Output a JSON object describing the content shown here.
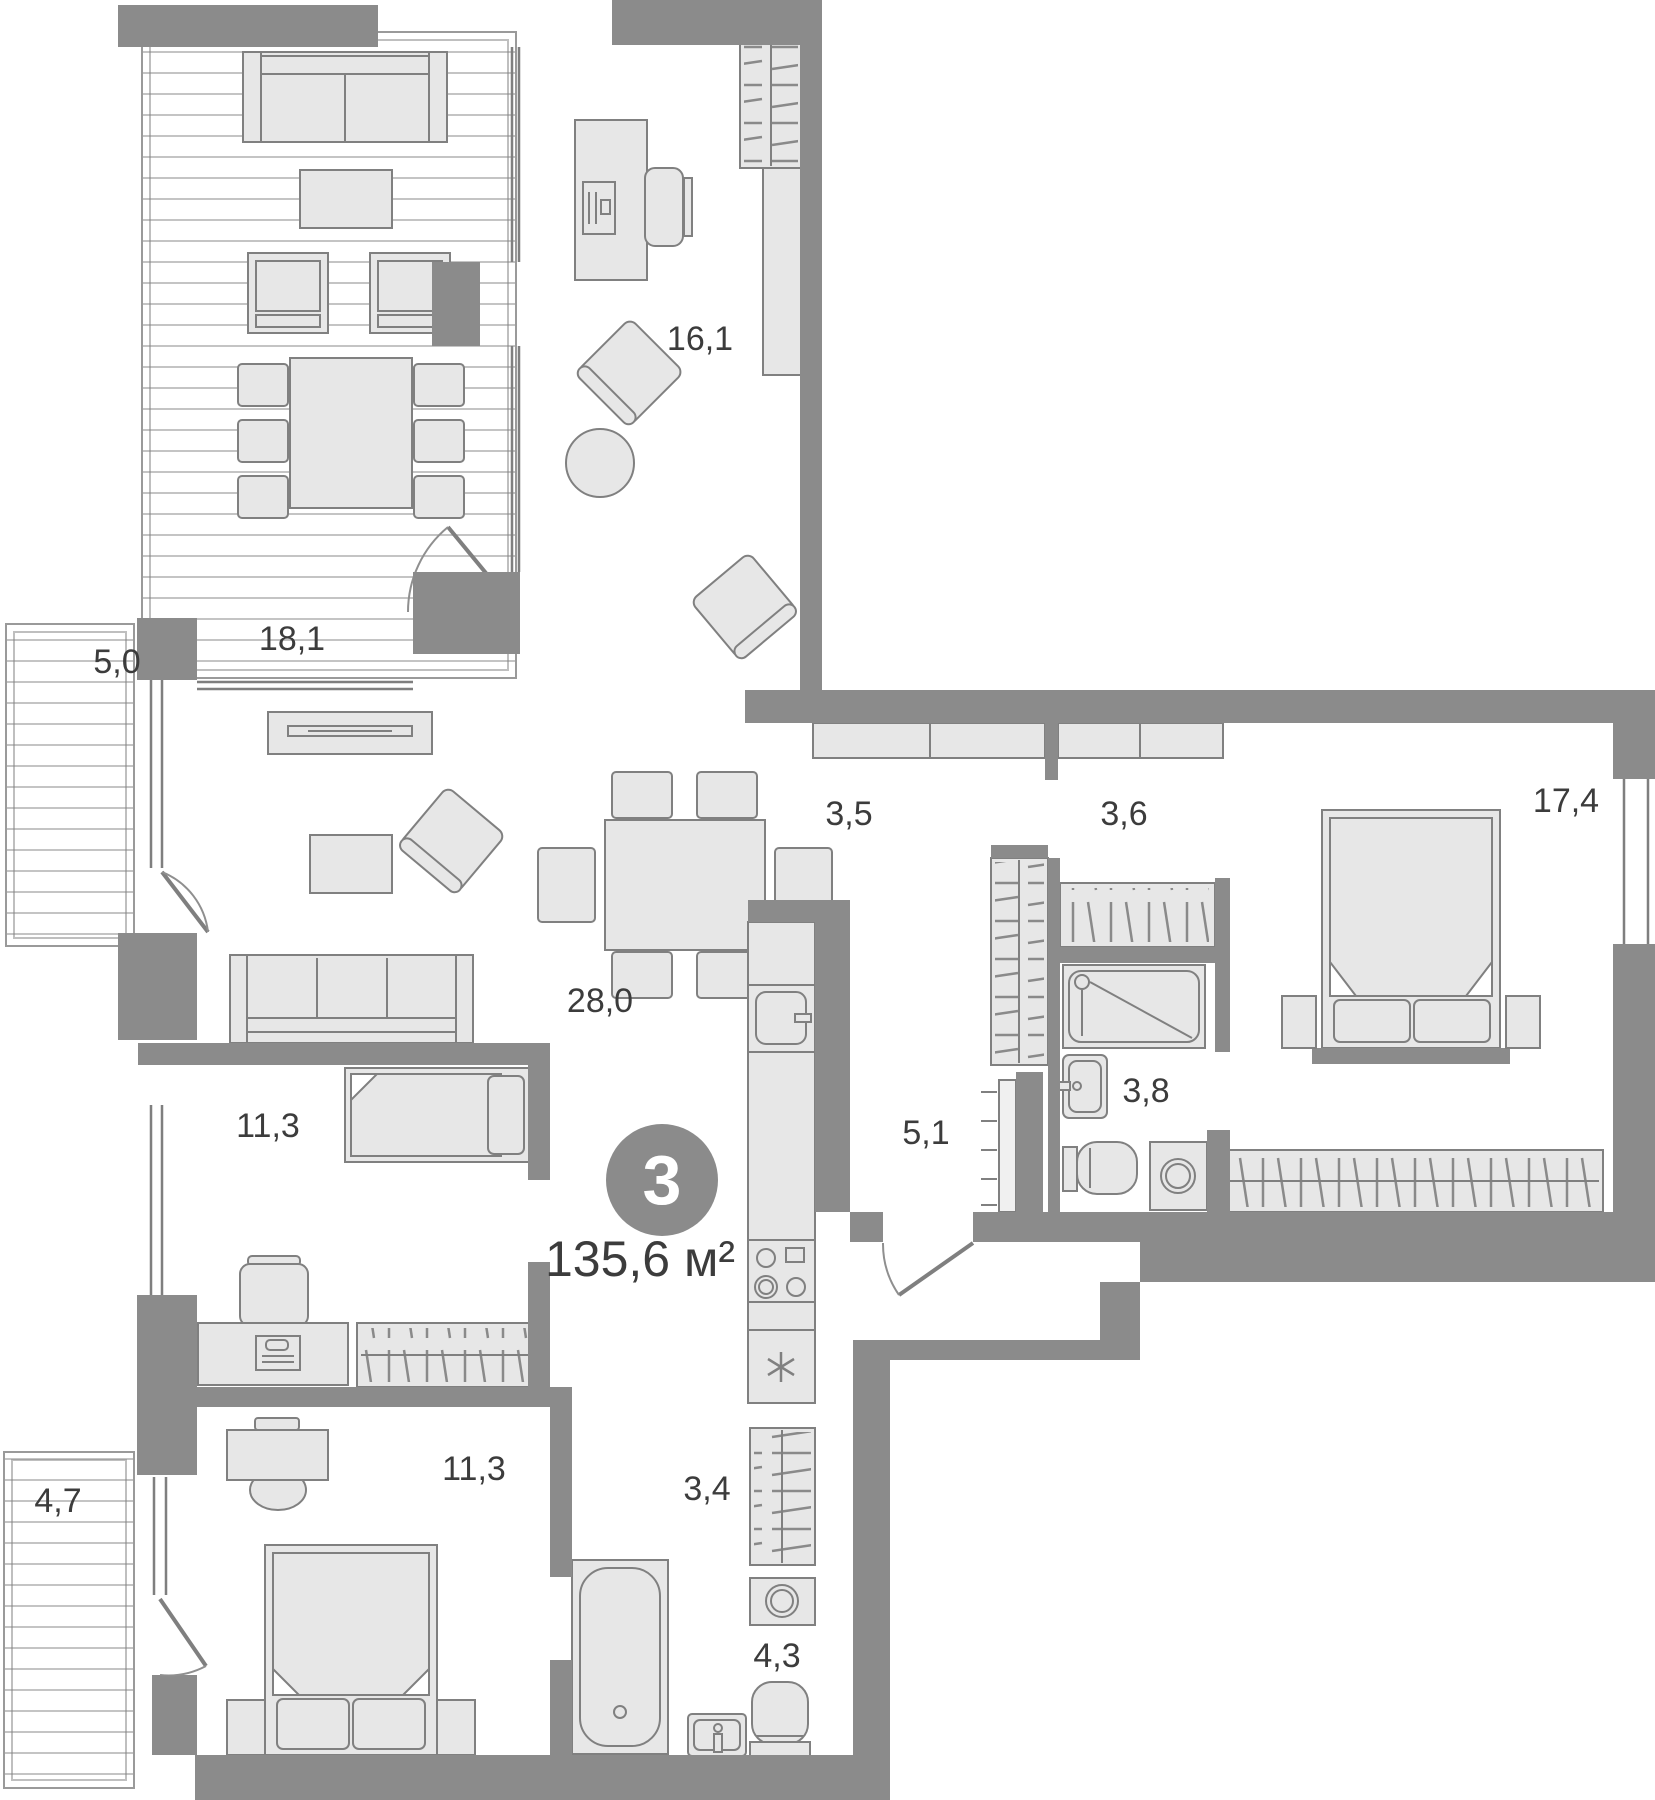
{
  "unit": {
    "number": "3",
    "total_area": "135,6 м²"
  },
  "rooms": [
    {
      "key": "terrace",
      "area": "18,1"
    },
    {
      "key": "study",
      "area": "16,1"
    },
    {
      "key": "balcony-top",
      "area": "5,0"
    },
    {
      "key": "hall-entry",
      "area": "3,5"
    },
    {
      "key": "hall-closet",
      "area": "3,6"
    },
    {
      "key": "bedroom-main",
      "area": "17,4"
    },
    {
      "key": "living-kitchen",
      "area": "28,0"
    },
    {
      "key": "room-middle",
      "area": "11,3"
    },
    {
      "key": "corridor",
      "area": "5,1"
    },
    {
      "key": "bathroom-top",
      "area": "3,8"
    },
    {
      "key": "closet-hall",
      "area": "3,4"
    },
    {
      "key": "bathroom-bottom",
      "area": "4,3"
    },
    {
      "key": "bedroom-bottom",
      "area": "11,3"
    },
    {
      "key": "balcony-bottom",
      "area": "4,7"
    }
  ],
  "colors": {
    "wall": "#8b8b8b",
    "furniture_fill": "#e7e7e7",
    "furniture_stroke": "#808080",
    "deck_line": "#b0b0b0",
    "label_text": "#3c3c3c",
    "badge_fill": "#8b8b8b",
    "badge_text": "#ffffff"
  }
}
